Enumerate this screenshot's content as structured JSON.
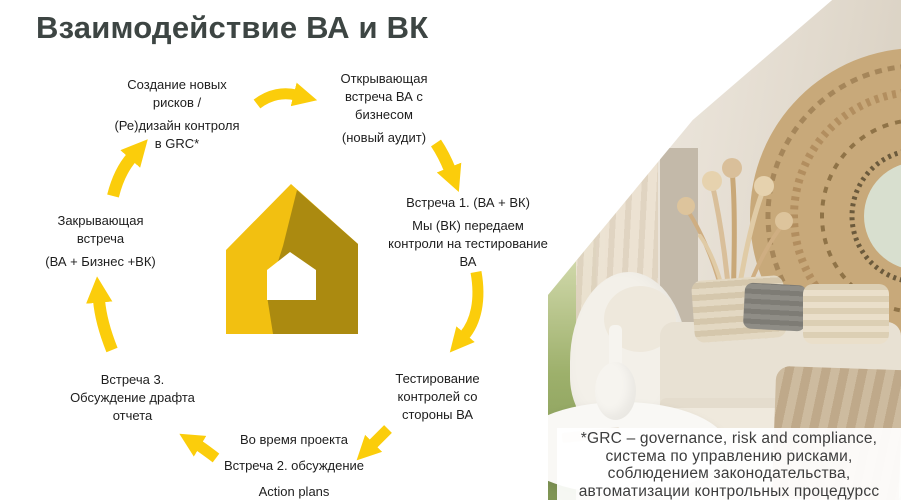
{
  "title": "Взаимодействие ВА и ВК",
  "diagram": {
    "create_risks": {
      "p1": "Создание новых\nрисков /",
      "p2": "(Ре)дизайн контроля\nв GRC*"
    },
    "opening_meeting": {
      "p1": "Открывающая\nвстреча ВА с\nбизнесом",
      "p2": "(новый аудит)"
    },
    "meeting_1": {
      "p1": "Встреча 1. (ВА + ВК)",
      "p2": "Мы (ВК) передаем\nконтроли на тестирование\nВА"
    },
    "testing": {
      "p1": "Тестирование\nконтролей со\nстороны ВА"
    },
    "during_project": {
      "p1": "Во время проекта",
      "p2": "Встреча 2. обсуждение",
      "p3": "Action plans"
    },
    "meeting_3": {
      "p1": "Встреча 3.\nОбсуждение драфта\nотчета"
    },
    "closing_meeting": {
      "p1": "Закрывающая\nвстреча",
      "p2": "(ВА + Бизнес +ВК)"
    }
  },
  "footnote": {
    "line1": "*GRC – governance, risk and compliance,",
    "line2": "система по управлению рисками,",
    "line3": "соблюдением законодательства,",
    "line4": "автоматизации контрольных процедурсс"
  },
  "colors": {
    "arrow_yellow": "#FBCD0B",
    "logo_bright_yellow": "#F2C011",
    "logo_dark_gold": "#AB8A10",
    "title_color": "#3D4543"
  }
}
